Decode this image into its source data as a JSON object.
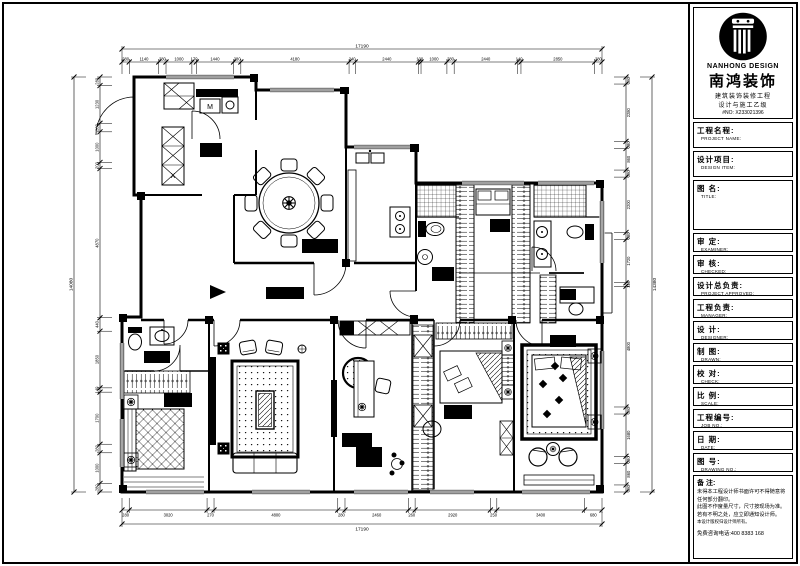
{
  "title_block": {
    "brand": {
      "logo_icon": "column-logo",
      "en": "NANHONG DESIGN",
      "cn": "南鸿装饰",
      "sub1": "建筑装饰装修工程",
      "sub2": "设计与施工乙级",
      "cert_no": "#NO: X233021396"
    },
    "fields": [
      {
        "cn": "工程名程:",
        "en": "PROJECT NAME:"
      },
      {
        "cn": "设计项目:",
        "en": "DESIGN ITEM:"
      },
      {
        "cn": "图  名:",
        "en": "TITLE:"
      },
      {
        "cn": "审  定:",
        "en": "EXAMINER:"
      },
      {
        "cn": "审  核:",
        "en": "CHECKED:"
      },
      {
        "cn": "设计总负责:",
        "en": "PROJECT APPROVED:"
      },
      {
        "cn": "工程负责:",
        "en": "MANAGER:"
      },
      {
        "cn": "设  计:",
        "en": "DESIGNER:"
      },
      {
        "cn": "制  图:",
        "en": "DRAWN:"
      },
      {
        "cn": "校  对:",
        "en": "CHECK:"
      },
      {
        "cn": "比  例:",
        "en": "SCALE:"
      },
      {
        "cn": "工程编号:",
        "en": "JOB NO.:"
      },
      {
        "cn": "日  期:",
        "en": "DATE:"
      },
      {
        "cn": "图  号:",
        "en": "DRAWING NO.:"
      }
    ],
    "notes": {
      "label": "备 注:",
      "line1": "未得本工程设计师书面许可不得随意将任何部分翻印。",
      "line2": "此图不作度量尺寸，尺寸按现场为准。",
      "line3": "若有不明之处，应立即通知设计师。",
      "line4": "本设计版权归设计师所有。",
      "hotline": "免费咨询电话:400 8383 168"
    }
  },
  "plan": {
    "microwave_label": "M",
    "cabinet_letter": "X"
  },
  "dims": {
    "top_total": [
      "17190"
    ],
    "top": [
      "280",
      "1140",
      "280",
      "1000",
      "170",
      "1440",
      "280",
      "4180",
      "240",
      "2440",
      "100",
      "1000",
      "280",
      "2440",
      "140",
      "2850",
      "280"
    ],
    "bottom": [
      "280",
      "3020",
      "270",
      "4800",
      "280",
      "2460",
      "260",
      "2920",
      "250",
      "3400",
      "680"
    ],
    "bottom_total": [
      "17190"
    ],
    "left": [
      "280",
      "1230",
      "280",
      "1000",
      "200",
      "4870",
      "440",
      "1850",
      "140",
      "1700",
      "280",
      "1000",
      "280"
    ],
    "left_total": [
      "14080"
    ],
    "right": [
      "280",
      "2280",
      "280",
      "860",
      "280",
      "2200",
      "280",
      "1720",
      "140",
      "4800",
      "280",
      "1680",
      "280",
      "860",
      "280"
    ],
    "right_total": [
      "14380"
    ]
  }
}
